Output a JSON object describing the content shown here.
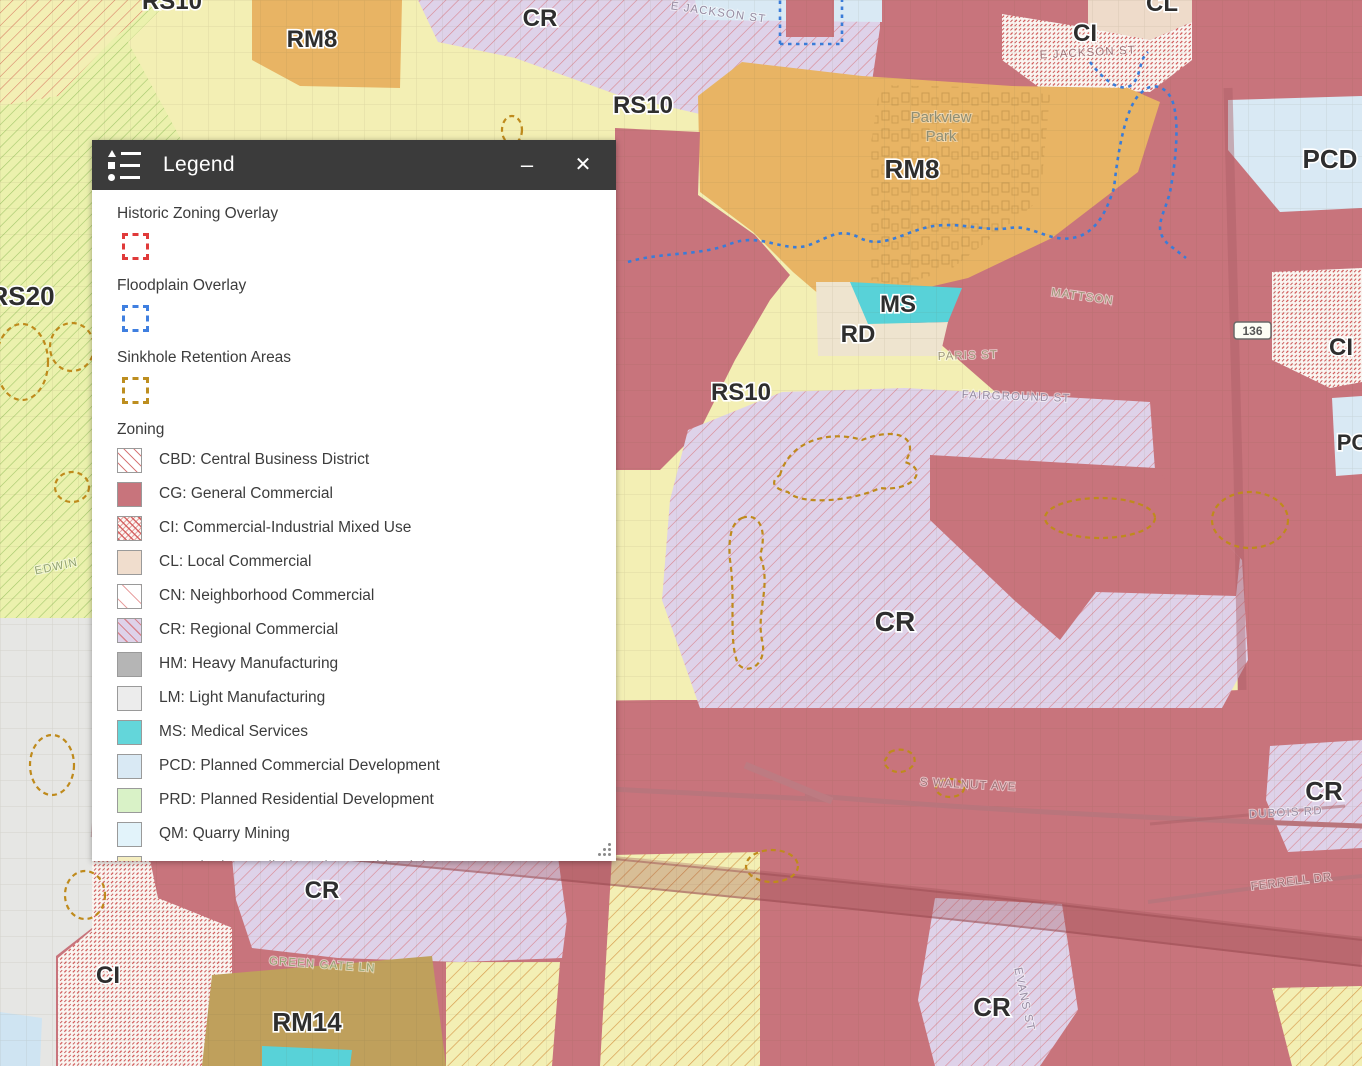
{
  "legend": {
    "header": {
      "title": "Legend",
      "minimize_label": "–",
      "close_label": "✕"
    },
    "overlays": [
      {
        "name": "Historic Zoning Overlay",
        "color": "#e03a3a"
      },
      {
        "name": "Floodplain Overlay",
        "color": "#3f7fe0"
      },
      {
        "name": "Sinkhole Retention Areas",
        "color": "#bd8e1f"
      }
    ],
    "zoning": {
      "title": "Zoning",
      "items": [
        {
          "code": "CBD",
          "label": "CBD: Central Business District",
          "color": "#ffffff",
          "hatch": "#d87a7a"
        },
        {
          "code": "CG",
          "label": "CG: General Commercial",
          "color": "#c8747c"
        },
        {
          "code": "CI",
          "label": "CI: Commercial-Industrial Mixed Use",
          "color": "#fbf6f2",
          "hatch": "#d05050"
        },
        {
          "code": "CL",
          "label": "CL: Local Commercial",
          "color": "#f0ddcd"
        },
        {
          "code": "CN",
          "label": "CN: Neighborhood Commercial",
          "color": "#ffffff",
          "hatch": "#e08282"
        },
        {
          "code": "CR",
          "label": "CR: Regional Commercial",
          "color": "#ded2e9",
          "hatch": "#d9848e"
        },
        {
          "code": "HM",
          "label": "HM: Heavy Manufacturing",
          "color": "#b5b5b5"
        },
        {
          "code": "LM",
          "label": "LM: Light Manufacturing",
          "color": "#ececec"
        },
        {
          "code": "MS",
          "label": "MS: Medical Services",
          "color": "#63d6da"
        },
        {
          "code": "PCD",
          "label": "PCD: Planned Commercial Development",
          "color": "#d9e9f4"
        },
        {
          "code": "PRD",
          "label": "PRD: Planned Residential Development",
          "color": "#d9f2c7"
        },
        {
          "code": "QM",
          "label": "QM: Quarry Mining",
          "color": "#e2f3fa"
        },
        {
          "code": "RD",
          "label": "RD: Single Family / Duplex Residential",
          "color": "#f5eec0"
        }
      ]
    }
  },
  "map": {
    "colors": {
      "residential_yellow": "#f3efb4",
      "general_commercial_red": "#c8747c",
      "multifamily_orange": "#e8b464",
      "regional_commercial_lavender": "#ded2e9",
      "medical_teal": "#58d2d8",
      "duplex_beige": "#eee4cf",
      "rm14_tan": "#bfa05c",
      "pcd_blue": "#d9e9f4",
      "local_commercial_tan": "#eedbca",
      "rs20_green_hatch": "#a3c76b",
      "floodplain_line": "#3a7cd8",
      "sinkhole_line": "#bf8a1c"
    },
    "zone_labels": [
      {
        "text": "RS10"
      },
      {
        "text": "RM8"
      },
      {
        "text": "CR"
      },
      {
        "text": "CI"
      },
      {
        "text": "CL"
      },
      {
        "text": "RS10"
      },
      {
        "text": "PCD"
      },
      {
        "text": "RM8"
      },
      {
        "text": "MS"
      },
      {
        "text": "RD"
      },
      {
        "text": "CI"
      },
      {
        "text": "RS10"
      },
      {
        "text": "RS20"
      },
      {
        "text": "CR"
      },
      {
        "text": "CR"
      },
      {
        "text": "CI"
      },
      {
        "text": "RM14"
      },
      {
        "text": "CR"
      },
      {
        "text": "CR"
      },
      {
        "text": "PC"
      }
    ],
    "street_labels": [
      {
        "text": "E JACKSON ST"
      },
      {
        "text": "E JACKSON ST"
      },
      {
        "text": "PARIS ST"
      },
      {
        "text": "MATTSON"
      },
      {
        "text": "FAIRGROUND ST"
      },
      {
        "text": "INTERSTATE DR"
      },
      {
        "text": "S WALNUT AVE"
      },
      {
        "text": "DUBOIS RD"
      },
      {
        "text": "FERRELL DR"
      },
      {
        "text": "GREEN GATE LN"
      },
      {
        "text": "EVANS ST"
      },
      {
        "text": "EDWIN"
      }
    ],
    "park_label": {
      "line1": "Parkview",
      "line2": "Park"
    },
    "shields": [
      {
        "text": "136"
      },
      {
        "text": "40"
      }
    ]
  }
}
